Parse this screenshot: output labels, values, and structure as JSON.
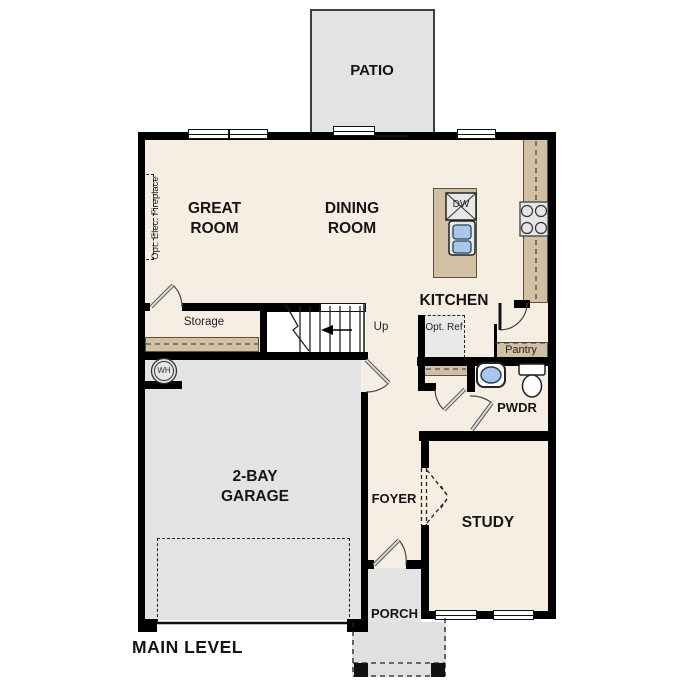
{
  "plan": {
    "title": "MAIN LEVEL",
    "rooms": {
      "patio": "PATIO",
      "great_room": "GREAT ROOM",
      "dining_room": "DINING ROOM",
      "kitchen": "KITCHEN",
      "storage": "Storage",
      "pantry": "Pantry",
      "powder": "PWDR",
      "garage": "2-BAY GARAGE",
      "foyer": "FOYER",
      "study": "STUDY",
      "porch": "PORCH"
    },
    "annotations": {
      "stairs_up": "Up",
      "dishwasher": "DW",
      "water_heater": "WH",
      "optional_refrigerator": "Opt. Ref",
      "optional_fireplace": "Opt. Elec. Fireplace"
    },
    "colors": {
      "background": "#ffffff",
      "floor": "#f6eee2",
      "hard_surface": "#e3e3e3",
      "counter": "#d2c0a4",
      "wall": "#000000",
      "sink_fixture": "#a9c7e8"
    }
  }
}
